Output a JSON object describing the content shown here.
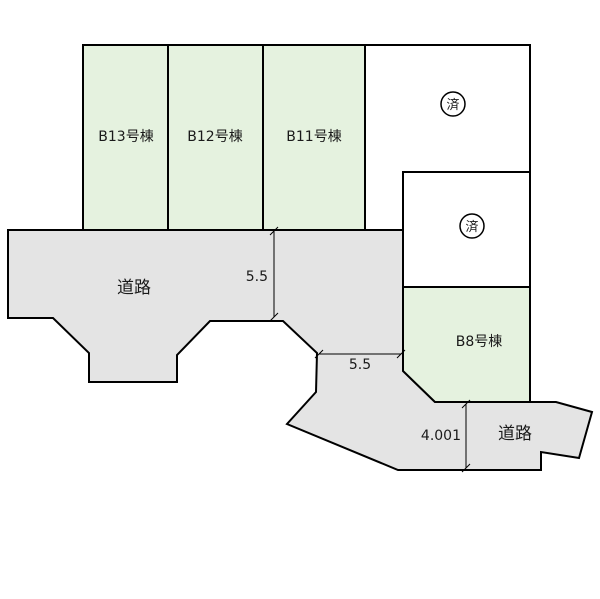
{
  "colors": {
    "background": "#ffffff",
    "parcel_green": "#e5f2df",
    "parcel_white": "#ffffff",
    "road_gray": "#e4e4e4",
    "line": "#000000"
  },
  "parcels": {
    "b13": {
      "label": "B13号棟",
      "status": "available"
    },
    "b12": {
      "label": "B12号棟",
      "status": "available"
    },
    "b11": {
      "label": "B11号棟",
      "status": "available"
    },
    "b8": {
      "label": "B8号棟",
      "status": "available"
    },
    "sold_upper": {
      "stamp": "済"
    },
    "sold_lower": {
      "stamp": "済"
    }
  },
  "roads": {
    "left": {
      "label": "道路"
    },
    "bottom": {
      "label": "道路"
    }
  },
  "dimensions": {
    "road_width_left_vertical": {
      "value": "5.5"
    },
    "road_width_middle_horizontal": {
      "value": "5.5"
    },
    "road_width_bottom_vertical": {
      "value": "4.001"
    }
  }
}
